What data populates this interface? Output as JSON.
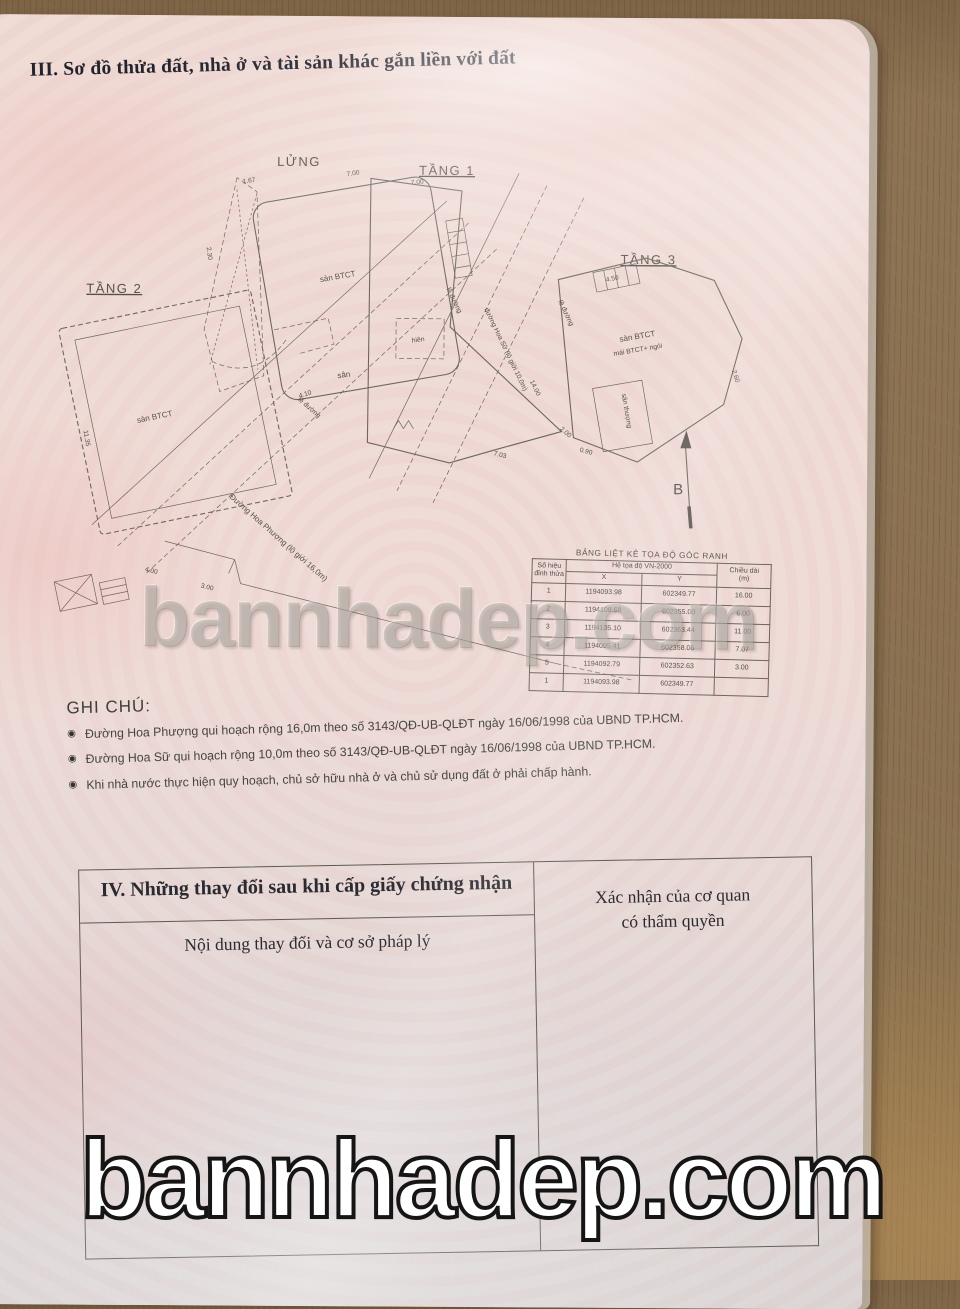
{
  "section3": {
    "title": "III. Sơ đồ thửa đất, nhà ở và tài sản khác gắn liền với đất"
  },
  "diagram": {
    "floors": {
      "lung": "LỬNG",
      "tang1": "TẦNG 1",
      "tang2": "TẦNG 2",
      "tang3": "TẦNG 3"
    },
    "labels": {
      "san_btct_lung": "sàn BTCT",
      "san_btct_tang2": "sàn BTCT",
      "tang3_line1": "sàn BTCT",
      "tang3_line2": "mái BTCT+ ngói",
      "san_thuong": "sân thượng",
      "san": "sân",
      "hien": "hiên",
      "le_duong_a": "lề đường",
      "le_duong_b": "lề đường",
      "le_duong_c": "lề đường"
    },
    "street1": "Đường Hoa Phượng (lộ giới 16,0m)",
    "street2": "đường Hoa Sữ (lộ giới 10,0m)",
    "north": "B",
    "dims": [
      "7.00",
      "2.30",
      "1.67",
      "4.10",
      "7.00",
      "7.03",
      "14.00",
      "2.00",
      "4.00",
      "3.00",
      "11.35",
      "4.50",
      "2.60",
      "0.90"
    ]
  },
  "coord_table": {
    "title": "BẢNG LIỆT KÊ TỌA ĐỘ GÓC RANH",
    "col_vertex_line1": "Số hiệu",
    "col_vertex_line2": "đỉnh thửa",
    "col_coords": "Hệ tọa độ VN-2000",
    "col_x": "X",
    "col_y": "Y",
    "col_len_line1": "Chiều dài",
    "col_len_line2": "(m)",
    "rows": [
      {
        "no": "1",
        "x": "1194093.98",
        "y": "602349.77",
        "len": "16.00"
      },
      {
        "no": "2",
        "x": "1194108.68",
        "y": "602355.00",
        "len": "6.00"
      },
      {
        "no": "3",
        "x": "1194105.10",
        "y": "602363.44",
        "len": "11.00"
      },
      {
        "no": "4",
        "x": "1194095.41",
        "y": "602358.06",
        "len": "7.07"
      },
      {
        "no": "5",
        "x": "1194092.79",
        "y": "602352.63",
        "len": "3.00"
      },
      {
        "no": "1",
        "x": "1194093.98",
        "y": "602349.77",
        "len": ""
      }
    ]
  },
  "notes": {
    "title": "GHI CHÚ:",
    "bullet": "◉",
    "items": [
      "Đường Hoa Phượng qui hoạch rộng 16,0m theo số 3143/QĐ-UB-QLĐT ngày 16/06/1998 của UBND TP.HCM.",
      "Đường Hoa Sữ qui hoạch rộng 10,0m theo số 3143/QĐ-UB-QLĐT ngày 16/06/1998 của UBND TP.HCM.",
      "Khi nhà nước thực hiện quy hoạch, chủ sở hữu nhà ở và chủ sử dụng đất ở phải chấp hành."
    ]
  },
  "section4": {
    "title": "IV. Những thay đổi sau khi cấp giấy chứng nhận",
    "col_content": "Nội dung thay đổi và cơ sở pháp lý",
    "col_confirm_line1": "Xác nhận của cơ quan",
    "col_confirm_line2": "có thẩm quyền"
  },
  "watermarks": {
    "center": "bannhadep.com",
    "bottom": "bannhadep.com"
  },
  "colors": {
    "paper_pink": "#eedad4",
    "wood_brown": "#8b7252",
    "ink": "#55504a",
    "watermark_fill": "#ffffff"
  }
}
